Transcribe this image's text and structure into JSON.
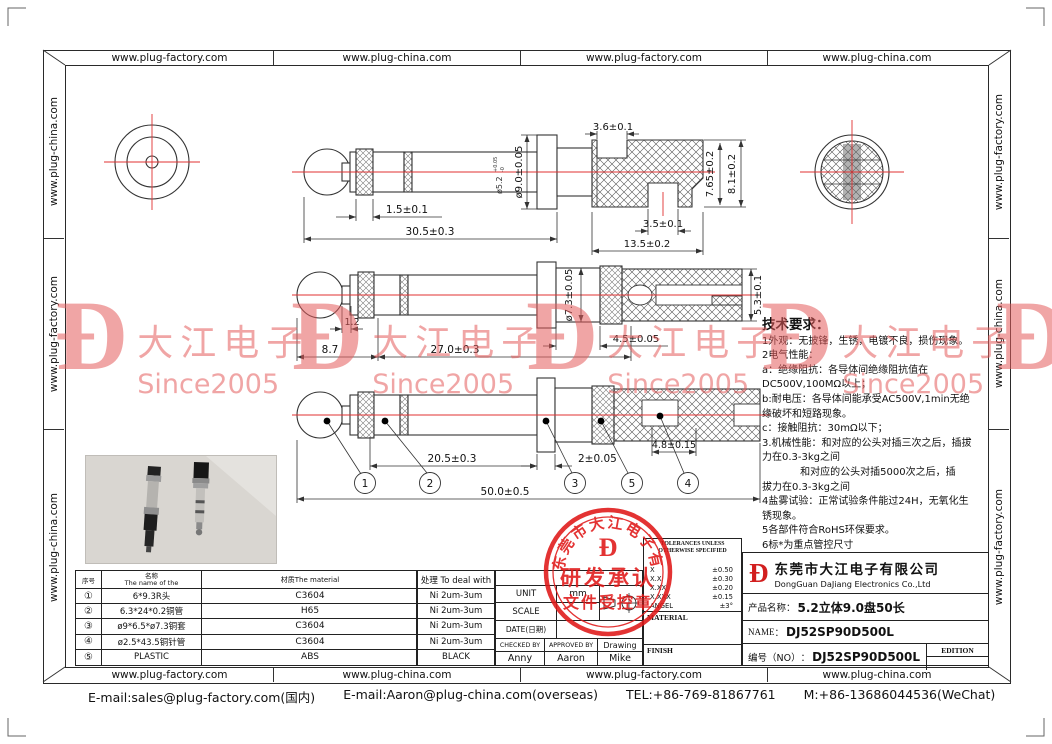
{
  "borders": {
    "top": [
      "www.plug-factory.com",
      "www.plug-china.com",
      "www.plug-factory.com",
      "www.plug-china.com"
    ],
    "bottom": [
      "www.plug-factory.com",
      "www.plug-china.com",
      "www.plug-factory.com",
      "www.plug-china.com"
    ],
    "left": [
      "www.plug-china.com",
      "www.plug-factory.com",
      "www.plug-china.com"
    ],
    "right": [
      "www.plug-factory.com",
      "www.plug-china.com",
      "www.plug-factory.com"
    ]
  },
  "watermark": {
    "glyph": "Ð",
    "name": "大江电子",
    "since": "Since2005"
  },
  "dims": {
    "top_view": {
      "knurl_len": "1.5±0.1",
      "plug_len": "30.5±0.3",
      "flange_dia": "ø9.0±0.05",
      "shaft_dia": "ø5.2",
      "shaft_tol_up": "+0.05",
      "shaft_tol_dn": "-0"
    },
    "handle": {
      "notch_top": "3.6±0.1",
      "inner_h": "7.65±0.2",
      "outer_h": "8.1±0.2",
      "notch_bottom": "3.5±0.1",
      "len": "13.5±0.2"
    },
    "mid_view": {
      "neck": "1.2",
      "ball": "8.7",
      "body": "27.0±0.3",
      "dia": "ø7.3±0.05",
      "len2": "4.5±0.05",
      "end_h": "5.3±0.1"
    },
    "bottom_view": {
      "shaft": "20.5±0.3",
      "disc": "2±0.05",
      "slot": "4.8±0.15",
      "total": "50.0±0.5"
    },
    "balloons": [
      "1",
      "2",
      "3",
      "5",
      "4"
    ]
  },
  "tech": {
    "title": "技术要求：",
    "lines": [
      "1外观：无披锋，生锈，电镀不良，损伤现象。",
      "2电气性能：",
      "a：绝缘阻抗：各导体间绝缘阻抗值在",
      "DC500V,100MΩ以上；",
      "b:耐电压：各导体间能承受AC500V,1min无绝",
      "缘破坏和短路现象。",
      "c：接触阻抗：30mΩ以下；",
      "3.机械性能：和对应的公头对插三次之后，插拔",
      "力在0.3-3kg之间",
      "            和对应的公头对插5000次之后，插",
      "拔力在0.3-3kg之间",
      "4盐雾试验：正常试验条件能过24H，无氧化生",
      "锈现象。",
      "5各部件符合RoHS环保要求。",
      "6标*为重点管控尺寸"
    ]
  },
  "parts_table": {
    "headers": {
      "no": "序号",
      "name_cn": "名称",
      "name_en": "The name of the",
      "material": "材质The material",
      "deal": "处理 To deal with"
    },
    "rows": [
      {
        "no": "①",
        "name": "6*9.3R头",
        "material": "C3604",
        "deal": "Ni 2um-3um"
      },
      {
        "no": "②",
        "name": "6.3*24*0.2铜管",
        "material": "H65",
        "deal": "Ni 2um-3um"
      },
      {
        "no": "③",
        "name": "ø9*6.5*ø7.3铜套",
        "material": "C3604",
        "deal": "Ni 2um-3um"
      },
      {
        "no": "④",
        "name": "ø2.5*43.5铜针管",
        "material": "C3604",
        "deal": "Ni 2um-3um"
      },
      {
        "no": "⑤",
        "name": "PLASTIC",
        "material": "ABS",
        "deal": "BLACK"
      }
    ]
  },
  "titleblock": {
    "unit_label": "UNIT",
    "unit_value": "mm",
    "scale_label": "SCALE",
    "date_label": "DATE(日期)",
    "checked_label": "CHECKED BY",
    "approved_label": "APPROVED BY",
    "drawing_label": "Drawing",
    "checked_by": "Anny",
    "approved_by": "Aaron",
    "drawn_by": "Mike",
    "tol_header": "TOLERANCES UNLESS OTHERWISE SPECIFIED",
    "tols": [
      {
        "l": "X",
        "v": "±0.50"
      },
      {
        "l": "X.X",
        "v": "±0.30"
      },
      {
        "l": "X.XX",
        "v": "±0.20"
      },
      {
        "l": "X.XXX",
        "v": "±0.15"
      },
      {
        "l": "ANGEL",
        "v": "±3°"
      }
    ],
    "material_label": "MATERIAL",
    "finish_label": "FINISH"
  },
  "company": {
    "logo": "Ð",
    "name_cn": "东莞市大江电子有限公司",
    "name_en": "DongGuan DaJiang Electronics Co.,Ltd",
    "product_label": "产品名称：",
    "product": "5.2立体9.0盘50长",
    "name_label": "NAME",
    "name_sep": "：",
    "part_name": "DJ52SP90D500L",
    "no_label": "编号（NO）",
    "no_sep": "：",
    "part_no": "DJ52SP90D500L",
    "edition": "EDITION"
  },
  "stamp": {
    "ring": "东莞市大江电子有限公司",
    "glyph": "Ð",
    "line1": "研发承认",
    "line2": "文件受控章"
  },
  "footer": {
    "email1": "E-mail:sales@plug-factory.com(国内)",
    "email2": "E-mail:Aaron@plug-china.com(overseas)",
    "tel": "TEL:+86-769-81867761",
    "mobile": "M:+86-13686044536(WeChat)"
  }
}
